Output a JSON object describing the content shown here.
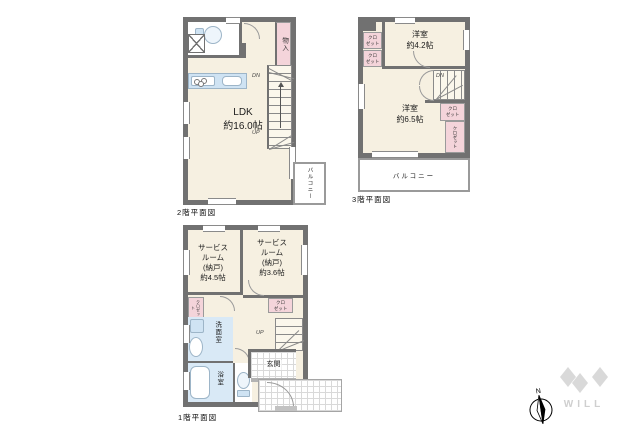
{
  "colors": {
    "wall": "#717171",
    "room_fill": "#f6f0e1",
    "closet_pink": "#f4d4da",
    "water_blue": "#d9e9f6",
    "logo_gray": "#d9d9d9"
  },
  "floor2": {
    "label": "2階平面図",
    "ldk": "LDK\n約16.0帖",
    "storage": "物入",
    "balcony": "バルコニー",
    "dn": "DN",
    "up": "UP"
  },
  "floor3": {
    "label": "3階平面図",
    "room_a": "洋室\n約4.2帖",
    "room_b": "洋室\n約6.5帖",
    "closet_left_top": "クロ\nゼット",
    "closet_left_bottom": "クロ\nゼット",
    "closet_right_small": "クロ\nゼット",
    "closet_right_tall": "クロゼット",
    "balcony": "バルコニー",
    "dn": "DN"
  },
  "floor1": {
    "label": "1階平面図",
    "service_a": "サービス\nルーム\n(納戸)\n約4.5帖",
    "service_b": "サービス\nルーム\n(納戸)\n約3.6帖",
    "closet_left": "クロゼット",
    "closet_right": "クロ\nゼット",
    "washroom": "洗面室",
    "bath": "浴室",
    "entrance": "玄関",
    "up": "UP"
  },
  "compass": {
    "north": "N"
  },
  "brand": {
    "name": "WILL"
  }
}
